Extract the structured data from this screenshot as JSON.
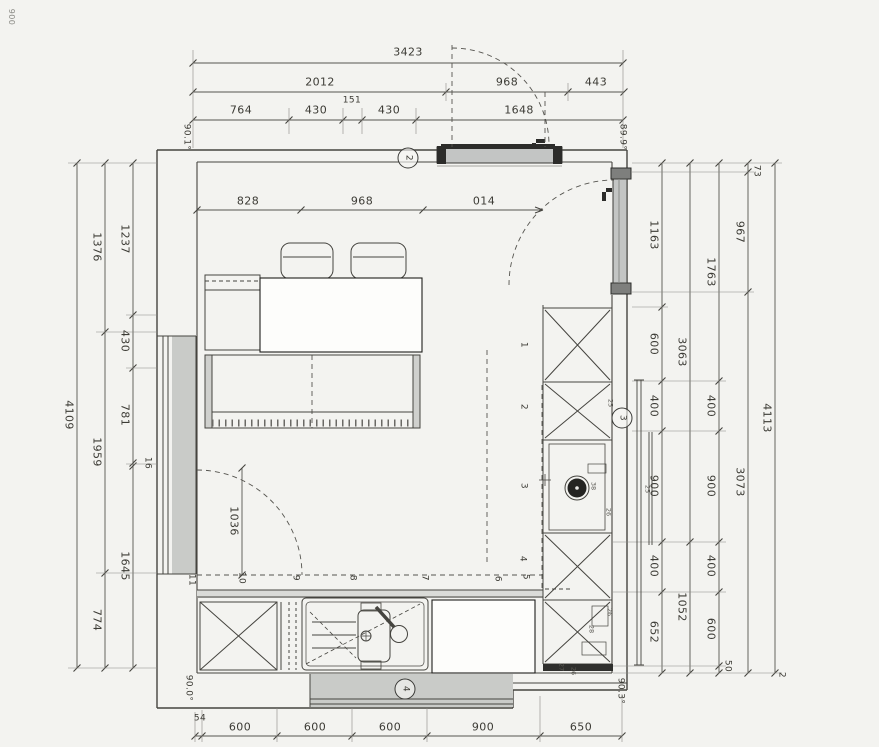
{
  "scan": {
    "corner_note": "900",
    "stray_mark": "2"
  },
  "angles": {
    "top_left": "90.1°",
    "top_right": "89.9°",
    "bottom_left": "90.0°",
    "bottom_right": "90.3°"
  },
  "markers": {
    "top_wall": "2",
    "right_wall": "3",
    "bottom_wall": "4"
  },
  "dims": {
    "top_total": "3423",
    "top_row2": [
      "2012",
      "968",
      "443"
    ],
    "top_row3": [
      "764",
      "430",
      "151",
      "430",
      "1648"
    ],
    "interior": [
      "828",
      "968",
      "014"
    ],
    "left_total": "4109",
    "left_mid": [
      "1376",
      "1959",
      "774"
    ],
    "left_inner": [
      "1237",
      "430",
      "781",
      "1645"
    ],
    "left_small": "16",
    "right_a": [
      "1163",
      "600",
      "400",
      "900",
      "400",
      "652"
    ],
    "right_b": [
      "3063",
      "1052"
    ],
    "right_c": [
      "1763",
      "400",
      "900",
      "400",
      "600",
      "50"
    ],
    "right_d": [
      "73",
      "967",
      "3073"
    ],
    "right_total": "4113",
    "bottom": [
      "54",
      "600",
      "600",
      "600",
      "900",
      "650"
    ],
    "door_swing": "1036",
    "radiator": "25"
  },
  "units": [
    "1",
    "2",
    "3",
    "4",
    "5",
    "6",
    "7",
    "8",
    "9",
    "10",
    "11"
  ],
  "small_marks": [
    "25",
    "38",
    "26",
    "26",
    "28",
    "27",
    "26"
  ]
}
